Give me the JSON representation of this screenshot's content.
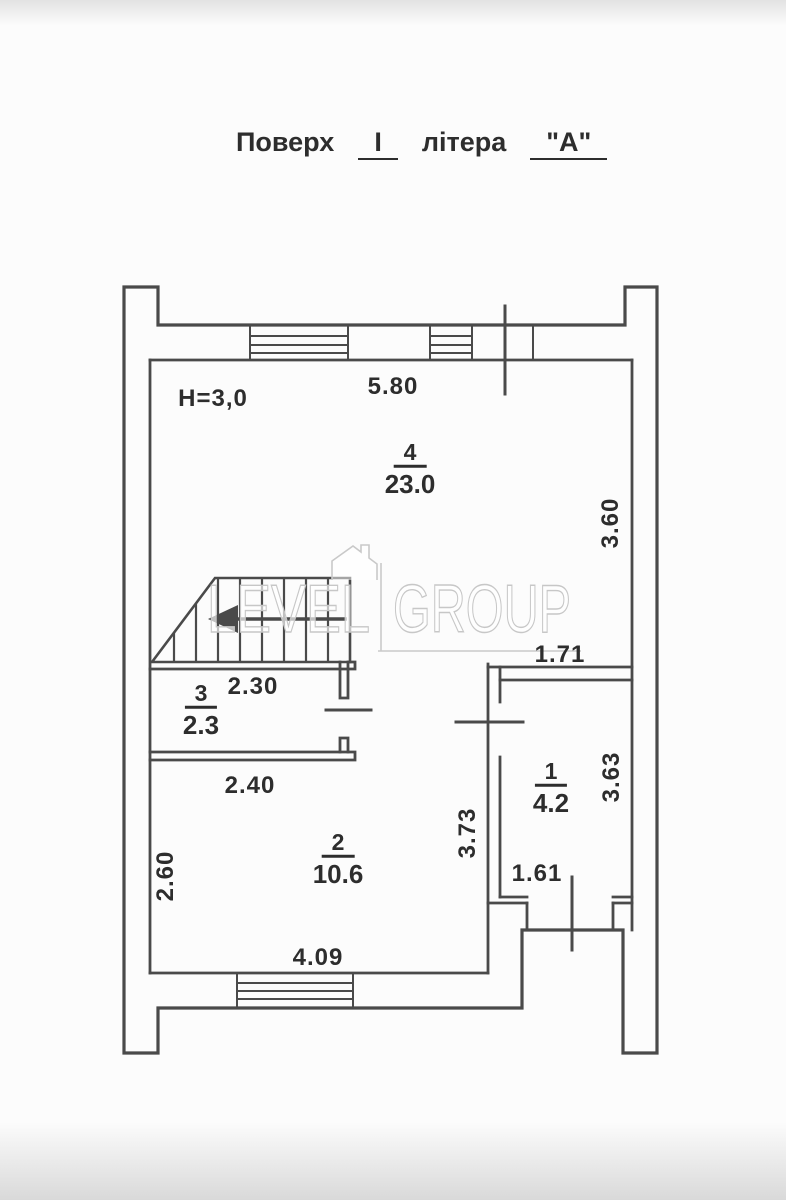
{
  "title": {
    "floor_label": "Поверх",
    "floor_value": "І",
    "letter_label": "літера",
    "letter_value": "\"А\""
  },
  "plan": {
    "height_note": "H=3,0",
    "rooms": [
      {
        "number": "4",
        "area": "23.0"
      },
      {
        "number": "3",
        "area": "2.3"
      },
      {
        "number": "2",
        "area": "10.6"
      },
      {
        "number": "1",
        "area": "4.2"
      }
    ],
    "dimensions": {
      "top_width": "5.80",
      "room4_right": "3.60",
      "room1_top": "1.71",
      "room3_width": "2.30",
      "room2_top_width": "2.40",
      "room2_left": "2.60",
      "room2_right": "3.73",
      "room1_right": "3.63",
      "room2_bottom": "4.09",
      "room1_bottom": "1.61"
    }
  },
  "watermark": {
    "left": "LEVEL",
    "right": "GROUP"
  }
}
